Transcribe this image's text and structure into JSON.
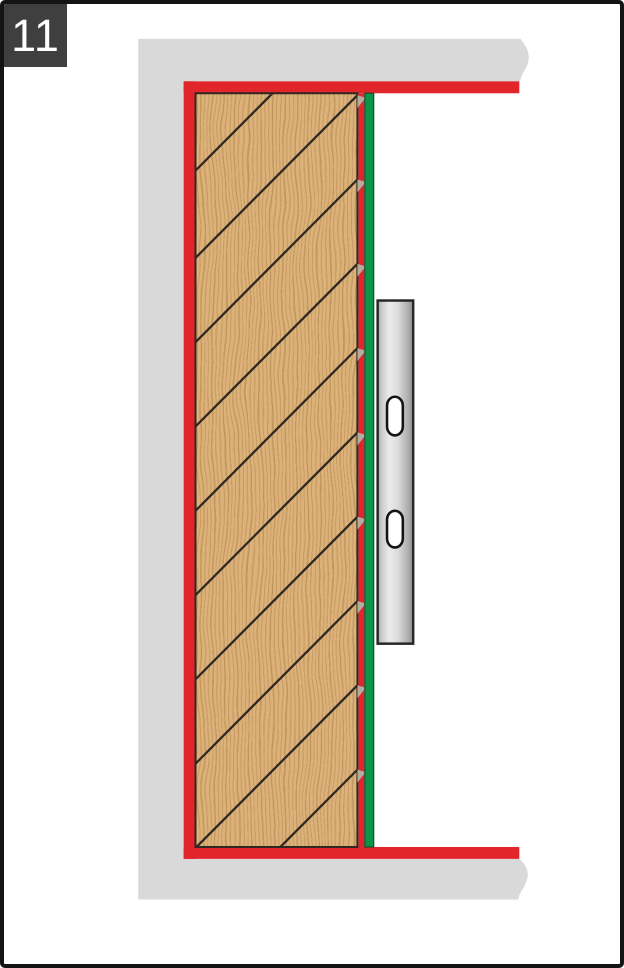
{
  "step_badge": {
    "number": "11"
  },
  "palette": {
    "page_border": "#141414",
    "badge_bg": "#3F3F3F",
    "badge_text": "#FFFFFF",
    "wall_gray": "#D9D9D9",
    "seal_red": "#E2242B",
    "tape_green": "#0C9449",
    "tape_edge": "#164C2B",
    "wood_base": "#DCB27A",
    "wood_grain": "#C0925A",
    "wood_grain_dark": "#AA7F49",
    "outline_dark": "#2E2822",
    "notch_gray": "#B5AC9C",
    "rail_outline": "#272727",
    "slot_outline": "#141414",
    "slot_fill": "#FFFFFF",
    "rail_grad": [
      "#A9A9A9",
      "#CCCCCC",
      "#EAEAEA",
      "#DEDEDE",
      "#AFAFAF",
      "#8F8F8F"
    ]
  },
  "diagram": {
    "canvas": {
      "width": 624,
      "height": 968
    },
    "wall": {
      "outer_left": 136,
      "outer_top": 35,
      "outer_bottom": 903,
      "inner_x": 182,
      "inner_top": 78,
      "inner_bottom": 862,
      "right_end": 523,
      "break_tip": 531
    },
    "seal": {
      "thickness": 12,
      "top": {
        "x": 182,
        "y": 78,
        "w": 340,
        "h": 12
      },
      "left": {
        "x": 182,
        "y": 78,
        "w": 12,
        "h": 784
      },
      "bottom": {
        "x": 182,
        "y": 850,
        "w": 340,
        "h": 12
      },
      "right_strip": {
        "x": 359,
        "y": 90,
        "w": 6,
        "h": 760
      }
    },
    "panel": {
      "x": 194,
      "y": 90,
      "w": 164,
      "h": 760,
      "hatch_right_edge_y": [
        92,
        177,
        262,
        347,
        432,
        517,
        602,
        687,
        772
      ],
      "hatch_top_edge_x": [
        272
      ],
      "grain_step": 4,
      "notch": {
        "w": 8.5,
        "h": 13
      }
    },
    "tape": {
      "x": 365,
      "y": 90,
      "w": 10,
      "h": 760
    },
    "rail": {
      "x": 378.5,
      "y": 299,
      "w": 36,
      "h": 346,
      "slots": [
        {
          "x": 388,
          "y": 396,
          "w": 16,
          "h": 39
        },
        {
          "x": 388,
          "y": 511,
          "w": 16,
          "h": 37
        }
      ]
    }
  }
}
